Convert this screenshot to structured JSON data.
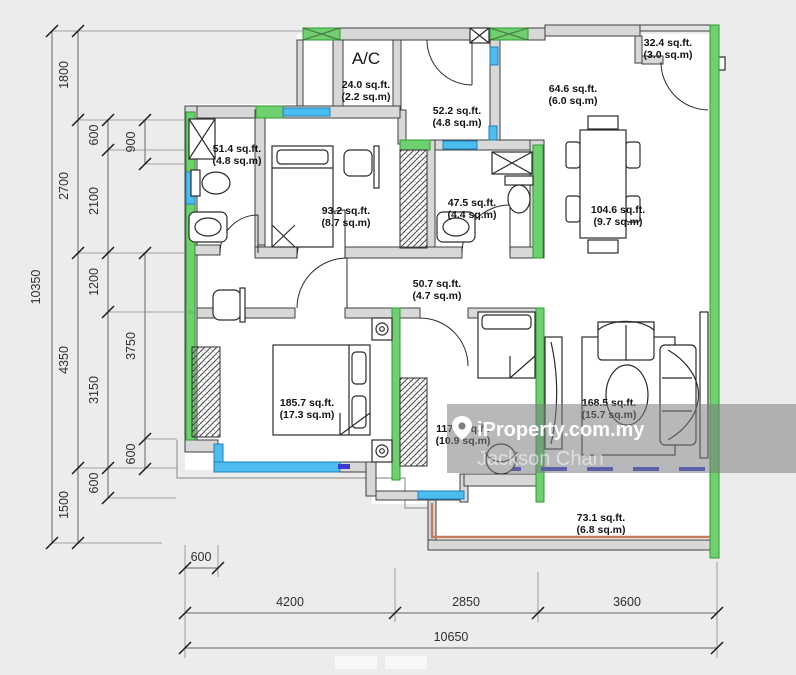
{
  "watermark": {
    "brand": "iProperty.com.my",
    "agent": "Jackson Chan",
    "pin_icon": "location-pin-icon"
  },
  "rooms": {
    "ac": {
      "name": "A/C",
      "sqft": "24.0 sq.ft.",
      "sqm": "(2.2 sq.m)"
    },
    "foyer": {
      "sqft": "52.2 sq.ft.",
      "sqm": "(4.8 sq.m)"
    },
    "balcony_top": {
      "sqft": "32.4 sq.ft.",
      "sqm": "(3.0 sq.m)"
    },
    "kitchen": {
      "sqft": "64.6 sq.ft.",
      "sqm": "(6.0 sq.m)"
    },
    "bath1": {
      "sqft": "51.4 sq.ft.",
      "sqm": "(4.8 sq.m)"
    },
    "bedroom2": {
      "sqft": "93.2 sq.ft.",
      "sqm": "(8.7 sq.m)"
    },
    "bath2": {
      "sqft": "47.5 sq.ft.",
      "sqm": "(4.4 sq.m)"
    },
    "dining": {
      "sqft": "104.6 sq.ft.",
      "sqm": "(9.7 sq.m)"
    },
    "hall": {
      "sqft": "50.7 sq.ft.",
      "sqm": "(4.7 sq.m)"
    },
    "master": {
      "sqft": "185.7 sq.ft.",
      "sqm": "(17.3 sq.m)"
    },
    "bedroom3": {
      "sqft": "117.3 sq.ft.",
      "sqm": "(10.9 sq.m)"
    },
    "living": {
      "sqft": "168.5 sq.ft.",
      "sqm": "(15.7 sq.m)"
    },
    "balcony": {
      "sqft": "73.1 sq.ft.",
      "sqm": "(6.8 sq.m)"
    }
  },
  "dimensions": {
    "left": {
      "total": "10350",
      "main": [
        "1800",
        "2700",
        "4350",
        "1500"
      ],
      "inner": [
        "600",
        "2100",
        "1200",
        "3150",
        "600"
      ],
      "innermost": [
        "900",
        "3750",
        "600"
      ]
    },
    "bottom": {
      "offset": "600",
      "segments": [
        "4200",
        "2850",
        "3600"
      ],
      "total": "10650"
    }
  },
  "colors": {
    "wall_gray": "#d8d8d8",
    "accent_green": "#6ed06e",
    "window_blue": "#4cbdf0",
    "sliding_door_blue": "#3a3ad6",
    "railing_orange": "#c87a5c"
  }
}
